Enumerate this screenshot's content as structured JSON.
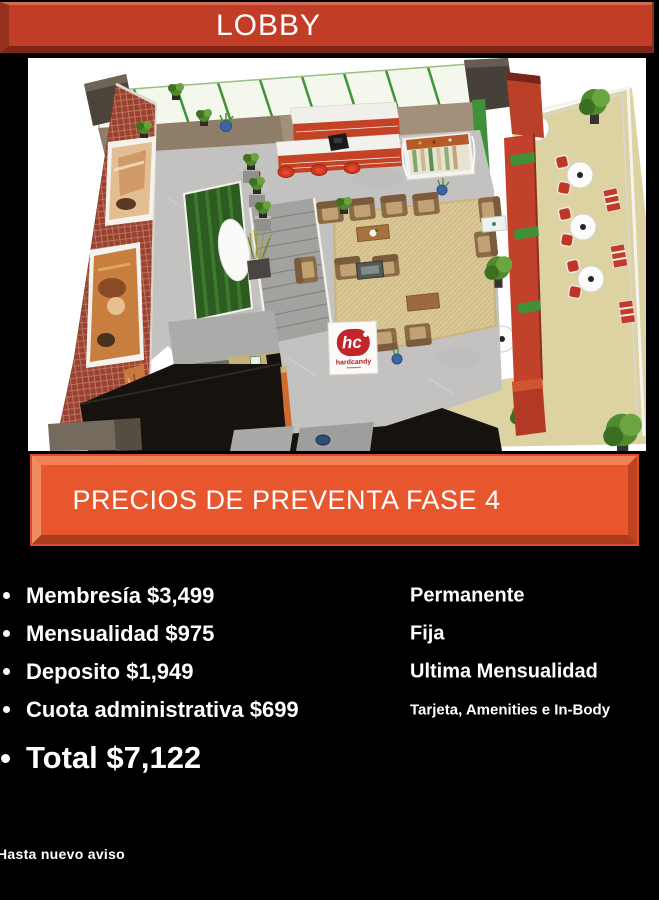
{
  "title_banner": {
    "label": "LOBBY"
  },
  "subtitle_banner": {
    "label": "PRECIOS DE PREVENTA FASE 4"
  },
  "pricing": {
    "items": [
      {
        "label": "Membresía $3,499",
        "note": "Permanente"
      },
      {
        "label": "Mensualidad $975",
        "note": "Fija"
      },
      {
        "label": "Deposito $1,949",
        "note": "Ultima Mensualidad"
      },
      {
        "label": "Cuota administrativa $699",
        "note": "Tarjeta, Amenities e In-Body"
      }
    ],
    "total": "Total $7,122"
  },
  "footnote": "Hasta nuevo aviso",
  "floorplan": {
    "logo": {
      "monogram": "hc",
      "brand": "hardcandy"
    }
  },
  "colors": {
    "background": "#000000",
    "title_banner_fill": "#C23D26",
    "subtitle_banner_fill": "#E8562D",
    "text": "#FFFFFF",
    "logo_red": "#C2252B"
  }
}
